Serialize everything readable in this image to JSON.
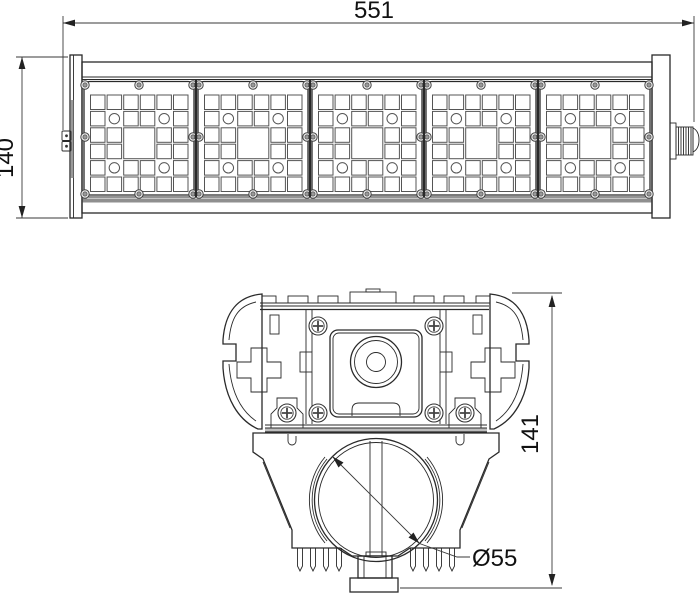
{
  "drawing": {
    "dimensions": {
      "overall_length": "551",
      "overall_width": "140",
      "section_height": "141",
      "pipe_diameter": "Ø55"
    },
    "front_view": {
      "led_module_count": 5
    },
    "colors": {
      "line": "#2a2a2a",
      "dimension_text": "#111111",
      "band_fill": "#8f8f8f"
    }
  }
}
